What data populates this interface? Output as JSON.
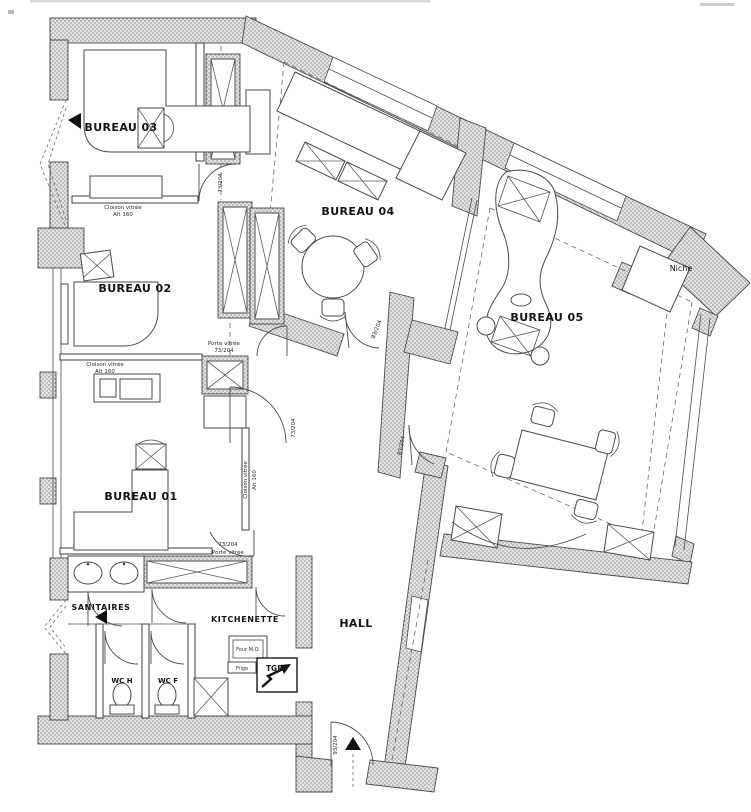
{
  "plan_type": "office floor plan",
  "labels": {
    "bureau01": "BUREAU 01",
    "bureau02": "BUREAU 02",
    "bureau03": "BUREAU 03",
    "bureau04": "BUREAU 04",
    "bureau05": "BUREAU 05",
    "sanitaires": "SANITAIRES",
    "kitchenette": "KITCHENETTE",
    "hall": "HALL",
    "wc_h": "WC H",
    "wc_f": "WC F",
    "niche": "Niche",
    "tgbt": "TGBT",
    "four_mo": "Four M.O.",
    "frigo": "Frigo",
    "cloison_vitree": "Cloison vitrée",
    "alt_160": "Alt 160",
    "porte_vitree": "Porte vitrée",
    "door_73": "73/204",
    "door_83": "83/204",
    "door_93": "93/204"
  },
  "colors": {
    "line": "#3c3c3c",
    "hatch_dot": "#8a8a8a",
    "hatch_bg": "#e3e3e3",
    "paper": "#ffffff",
    "text": "#141414"
  }
}
